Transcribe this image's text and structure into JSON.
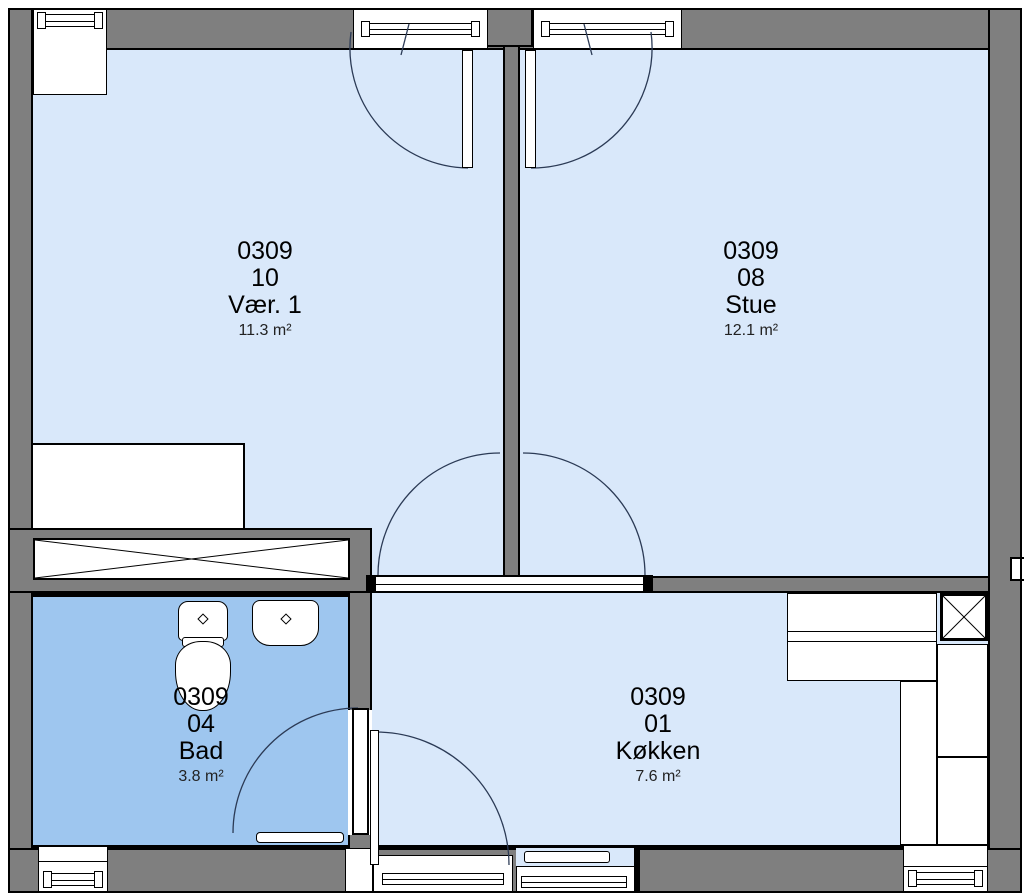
{
  "plan": {
    "rooms": [
      {
        "number": "0309",
        "unit": "10",
        "name": "Vær. 1",
        "area": "11.3 m²"
      },
      {
        "number": "0309",
        "unit": "08",
        "name": "Stue",
        "area": "12.1 m²"
      },
      {
        "number": "0309",
        "unit": "04",
        "name": "Bad",
        "area": "3.8 m²"
      },
      {
        "number": "0309",
        "unit": "01",
        "name": "Køkken",
        "area": "7.6 m²"
      }
    ],
    "colors": {
      "wall": "#7f7f7f",
      "floor": "#d9e8fa",
      "bath_floor": "#9ec6ef",
      "line": "#000000",
      "door_arc": "#2b3a55"
    },
    "icons": [
      "toilet-icon",
      "sink-icon",
      "bath-mat-icon",
      "kitchen-counter-icon",
      "duct-shaft-x-icon",
      "wardrobe-icon",
      "window-glass-icon",
      "door-leaf-icon"
    ]
  }
}
